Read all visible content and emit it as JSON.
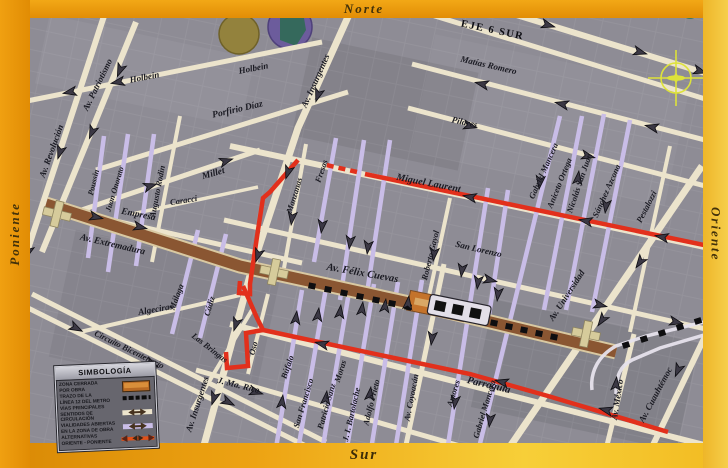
{
  "frame": {
    "north": "Norte",
    "south": "Sur",
    "west": "Poniente",
    "east": "Oriente"
  },
  "labels": {
    "eje_6_sur": "EJE 6 SUR",
    "matias_romero": "Matías Romero",
    "pilares": "Pilares",
    "miguel_laurent": "Miguel Laurent",
    "san_lorenzo": "San Lorenzo",
    "felix_cuevas": "Av. Félix Cuevas",
    "parroquia": "Parroquia",
    "holbein_w": "Holbein",
    "holbein_e": "Holbein",
    "porfirio_diaz": "Porfirio Díaz",
    "millet": "Millet",
    "carracci": "Caracci",
    "empresa": "Empresa",
    "extremadura": "Av. Extremadura",
    "algeciras": "Algeciras",
    "circuito": "Circuito Bicentenario",
    "las_bringas": "Las Bringas",
    "j_ma_rico": "J. Ma. Rico",
    "insurgentes_n": "Av. Insurgentes",
    "insurgentes_s": "Av. Insurgentes",
    "revolucion": "Av. Revolución",
    "patriotismo": "Av. Patriotismo",
    "poussin": "Poussin",
    "juan_onorato": "Juan Onorato",
    "augusto_rodin": "Augusto Rodin",
    "manzanas": "Manzanas",
    "fresas": "Fresas",
    "malaga": "Málaga",
    "cadiz": "Cádiz",
    "oso": "Oso",
    "bufalo": "Búfalo",
    "san_francisco": "San Francisco",
    "patricio_sanz": "Patricio Sanz",
    "moras": "Moras",
    "bartolache": "J. I. Bartolache",
    "adolfo_prieto": "Adolfo Prieto",
    "coyoacan": "Av. Coyoacán",
    "amores": "Amores",
    "mancera_s": "Gabriel Mancera",
    "mancera_n": "Gabriel Mancera",
    "roberto_gayol": "Roberto Gayol",
    "aniceto_ortega": "Aniceto Ortega",
    "nicolas_san_juan": "Nicolás San Juan",
    "sanchez_azcona": "Sánchez Azcona",
    "pestalozzi": "Pestalozzi",
    "universidad": "Av. Universidad",
    "mexico": "Av. México",
    "cuauhtemoc": "Av. Cuauhtémoc"
  },
  "legend": {
    "title": "SIMBOLOGÍA",
    "items": [
      {
        "line1": "ZONA CERRADA",
        "line2": "POR OBRA"
      },
      {
        "line1": "TRAZO DE LA",
        "line2": "LÍNEA 12 DEL METRO"
      },
      {
        "line1": "VÍAS PRINCIPALES",
        "line2": "SENTIDOS DE CIRCULACIÓN"
      },
      {
        "line1": "VIALIDADES ABIERTAS",
        "line2": "EN LA ZONA DE OBRA"
      },
      {
        "line1": "ALTERNATIVAS",
        "line2": "ORIENTE - PONIENTE"
      }
    ]
  },
  "colors": {
    "closed_zone": "#8a5632",
    "metro_line": "#111111",
    "main_roads": "#ece4cc",
    "open_roads": "#c9bde7",
    "alternative_route": "#e2301c",
    "border_orange": "#e9990d",
    "border_yellow": "#f2c53d",
    "map_background": "#8e8c95"
  }
}
